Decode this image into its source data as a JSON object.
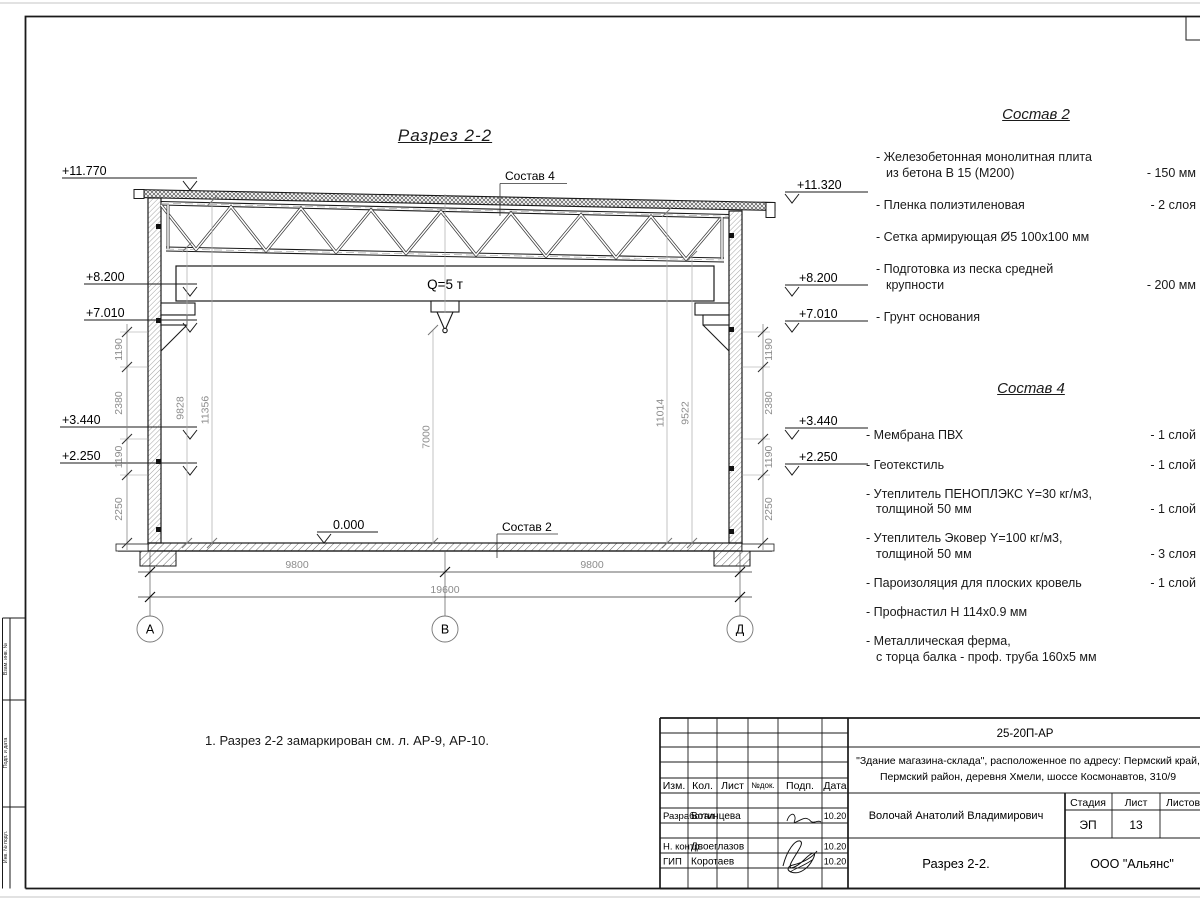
{
  "sheet": {
    "side_strip": [
      "Взам. инв. №",
      "Подп. и дата",
      "Инв. № подл."
    ]
  },
  "drawing": {
    "title": "Разрез 2-2",
    "note": "1. Разрез 2-2 замаркирован см. л. АР-9, АР-10.",
    "crane_capacity": "Q=5 т",
    "callout_roof": "Состав 4",
    "callout_floor": "Состав 2",
    "zero_level": "0.000",
    "elev_left": [
      "+11.770",
      "+8.200",
      "+7.010",
      "+3.440",
      "+2.250"
    ],
    "elev_right": [
      "+11.320",
      "+8.200",
      "+7.010",
      "+3.440",
      "+2.250"
    ],
    "chain": [
      "1190",
      "2380",
      "1190",
      "2250"
    ],
    "interior": [
      "9828",
      "11356",
      "7000",
      "11014",
      "9522"
    ],
    "bottom": [
      "9800",
      "9800",
      "19600"
    ],
    "axes": [
      "А",
      "В",
      "Д"
    ]
  },
  "spec2": {
    "title": "Состав 2",
    "items": [
      {
        "name": "- Железобетонная  монолитная плита\nиз бетона В 15 (М200)",
        "value": "- 150 мм"
      },
      {
        "name": "- Пленка полиэтиленовая",
        "value": "-  2 слоя"
      },
      {
        "name": "- Сетка армирующая Ø5 100х100 мм",
        "value": ""
      },
      {
        "name": "- Подготовка из песка средней\nкрупности",
        "value": "- 200 мм"
      },
      {
        "name": "- Грунт основания",
        "value": ""
      }
    ]
  },
  "spec4": {
    "title": "Состав 4",
    "items": [
      {
        "name": "- Мембрана ПВХ",
        "value": "- 1 слой"
      },
      {
        "name": "- Геотекстиль",
        "value": "- 1 слой"
      },
      {
        "name": "- Утеплитель ПЕНОПЛЭКС Y=30 кг/м3,\nтолщиной 50 мм",
        "value": "- 1 слой"
      },
      {
        "name": "- Утеплитель Эковер Y=100 кг/м3,\nтолщиной 50 мм",
        "value": "- 3 слоя"
      },
      {
        "name": "- Пароизоляция для плоских кровель",
        "value": "- 1 слой"
      },
      {
        "name": "- Профнастил Н 114х0.9 мм",
        "value": ""
      },
      {
        "name": "- Металлическая ферма,\nс торца балка - проф. труба 160х5 мм",
        "value": ""
      }
    ]
  },
  "titleblock": {
    "doc_number": "25-20П-АР",
    "object_line1": "\"Здание магазина-склада\", расположенное по адресу: Пермский край,",
    "object_line2": "Пермский район, деревня Хмели, шоссе Космонавтов, 310/9",
    "cols": {
      "izm": "Изм.",
      "kol": "Кол.",
      "list": "Лист",
      "ndok": "№док.",
      "podp": "Подп.",
      "data": "Дата"
    },
    "rows": [
      {
        "role": "Разработал",
        "name": "Вотинцева",
        "date": "10.20"
      },
      {
        "role": "Н. контр.",
        "name": "Двоеглазов",
        "date": "10.20"
      },
      {
        "role": "ГИП",
        "name": "Коротаев",
        "date": "10.20"
      }
    ],
    "author": "Волочай Анатолий Владимирович",
    "stage_label": "Стадия",
    "sheet_label": "Лист",
    "sheets_label": "Листов",
    "stage": "ЭП",
    "sheet_no": "13",
    "drawing_name": "Разрез 2-2.",
    "company": "ООО \"Альянс\""
  }
}
